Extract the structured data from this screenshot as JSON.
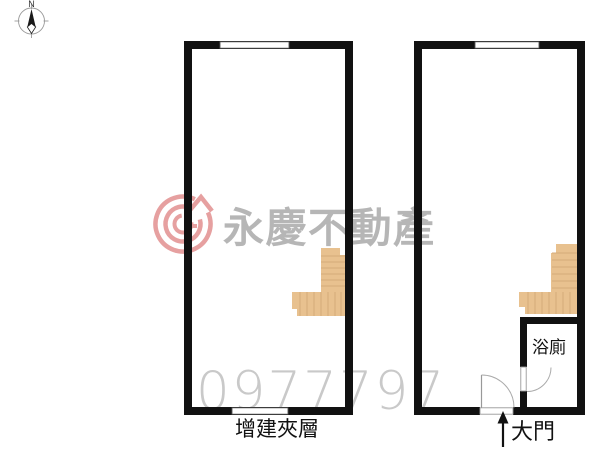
{
  "meta": {
    "width": 600,
    "height": 450,
    "background": "#ffffff",
    "type": "real-estate floor plan with two units"
  },
  "compass": {
    "north_label": "N"
  },
  "watermark": {
    "brand": "永慶不動產",
    "phone": "0977797",
    "brand_color": "#b6b6b6",
    "phone_color": "#c9c9c9",
    "logo_color": "#e6a0a0",
    "logo_icon": "yungching-circle-arrow-logo"
  },
  "left_plan": {
    "label": "增建夾層",
    "features": [
      "top-window",
      "bottom-window",
      "l-shaped-stairs"
    ]
  },
  "right_plan": {
    "bathroom_label": "浴廁",
    "door_label": "大門",
    "features": [
      "top-window",
      "l-shaped-stairs",
      "bathroom",
      "bathroom-door",
      "main-entrance-door",
      "entrance-arrow"
    ]
  },
  "colors": {
    "wall": "#111111",
    "stairs_fill": "#e8c18f",
    "stairs_tread_line": "#d5ab79",
    "door_line": "#aaaaaa",
    "window_outline": "#555555",
    "compass_line": "#999999"
  }
}
